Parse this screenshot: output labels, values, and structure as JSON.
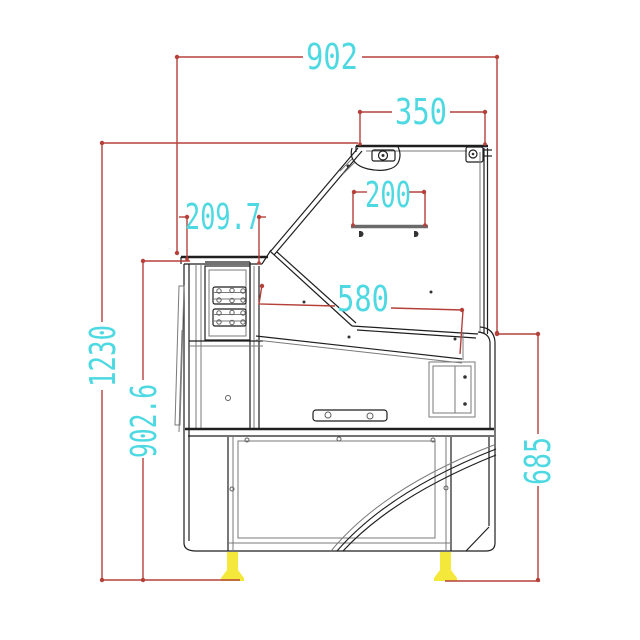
{
  "drawing": {
    "type": "technical-section-drawing",
    "dimensions": {
      "overall_width": "902",
      "canopy_depth": "350",
      "vent_opening": "200",
      "rear_top_depth": "209.7",
      "deck_length": "580",
      "overall_height": "1230",
      "rear_height": "902.6",
      "front_height": "685"
    },
    "colors": {
      "dim_line": "#b5403a",
      "dim_text": "#4ed9e2",
      "linework": "#1f1f1f",
      "linework_light": "#7a7a7a",
      "foot": "#f4e93a",
      "background": "#ffffff"
    }
  }
}
